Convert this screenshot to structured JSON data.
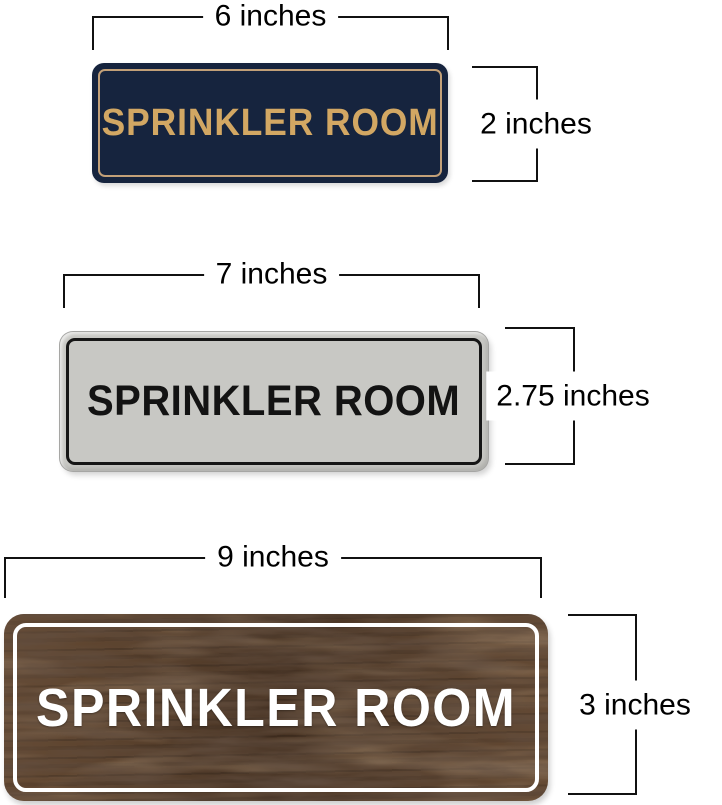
{
  "title": "Sprinkler Room sign size comparison",
  "dimension_style": {
    "line_color": "#111111",
    "text_color": "#000000"
  },
  "signs": [
    {
      "name": "navy-gold",
      "text": "SPRINKLER ROOM",
      "width_label": "6 inches",
      "height_label": "2 inches",
      "colors": {
        "background": "#16243e",
        "frame": "#c2a078",
        "text": "#d2a763"
      }
    },
    {
      "name": "silver-black",
      "text": "SPRINKLER ROOM",
      "width_label": "7 inches",
      "height_label": "2.75 inches",
      "colors": {
        "background": "#c8c8c4",
        "frame": "#161616",
        "text": "#131313"
      }
    },
    {
      "name": "walnut-white",
      "text": "SPRINKLER ROOM",
      "width_label": "9 inches",
      "height_label": "3 inches",
      "colors": {
        "background": "#58402c",
        "frame": "#ffffff",
        "text": "#ffffff"
      }
    }
  ]
}
